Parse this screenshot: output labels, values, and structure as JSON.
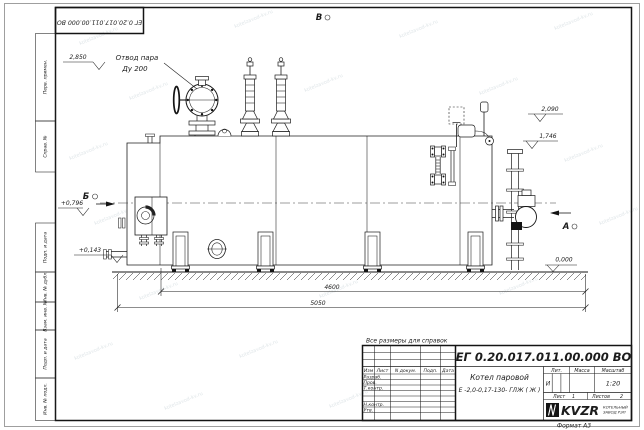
{
  "sheet": {
    "format_label": "Формат А3",
    "watermark_text": "kotelzavod-kv.ru"
  },
  "margin_stamps": {
    "flipped_doc_number": "ЕГ 0.20.017.011.00.000  ВО",
    "perv_primen": "Перв. примен.",
    "sprav_no": "Справ. №",
    "podp_data_1": "Подп. и дата",
    "inv_dubl": "Инв. № дубл.",
    "vzam_inv": "Взам. инв. №",
    "podp_data_2": "Подп. и дата",
    "inv_podl": "Инв. № подл."
  },
  "annotations": {
    "steam_outlet_line1": "Отвод пара",
    "steam_outlet_line2": "Ду 200",
    "elev_2850": "2,850",
    "elev_2090": "2,090",
    "elev_1746": "1,746",
    "elev_0796": "+0,796",
    "elev_0143": "+0,143",
    "elev_0000": "0,000",
    "dim_4600": "4600",
    "dim_5050": "5050",
    "view_a": "А",
    "view_b": "Б",
    "view_v": "В"
  },
  "title_block": {
    "reference_note": "Все размеры для справок",
    "doc_number": "ЕГ 0.20.017.011.00.000  ВО",
    "product_line1": "Котел паровой",
    "product_line2": "Е -2,0-0,17-130- ГЛЖ ( Ж )",
    "col_izm": "Изм",
    "col_list": "Лист",
    "col_docnum": "N докум.",
    "col_podp": "Подп.",
    "col_data": "Дата",
    "row_razrab": "Разраб.",
    "row_prov": "Пров.",
    "row_tkontr": "Т.контр.",
    "row_nkontr": "Н.контр.",
    "row_utv": "Утв.",
    "lit_label": "Лит.",
    "mass_label": "Масса",
    "scale_label": "Масштаб",
    "lit_value": "И",
    "scale_value": "1:20",
    "sheet_label": "Лист",
    "sheet_value": "1",
    "sheets_label": "Листов",
    "sheets_value": "2",
    "logo_text": "KVZR",
    "company_line1": "КОТЕЛЬНЫЙ",
    "company_line2": "ЗАВОД РЭП"
  }
}
